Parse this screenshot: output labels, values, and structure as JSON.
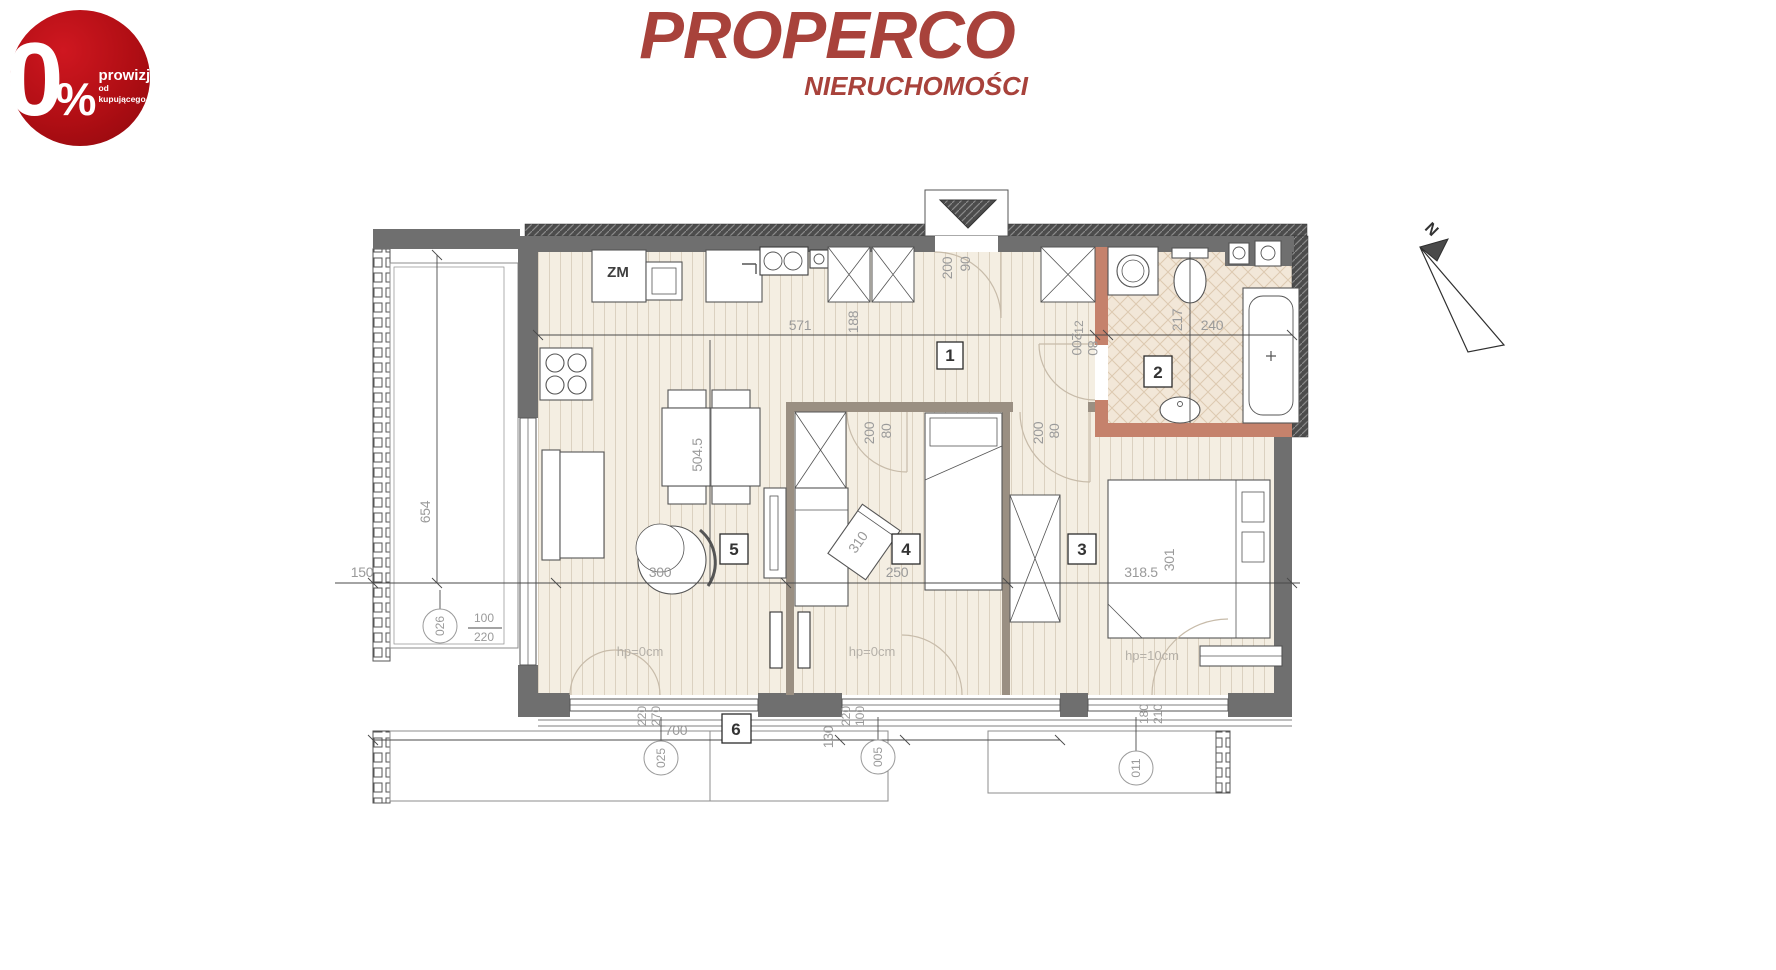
{
  "badge": {
    "zero": "0",
    "percent": "%",
    "line1": "prowizji",
    "line2": "od kupującego",
    "color": "#b00e14"
  },
  "logo": {
    "title": "PROPERCO",
    "subtitle": "NIERUCHOMOŚCI",
    "color": "#a8423b"
  },
  "plan": {
    "compass_n": "N",
    "room_numbers": {
      "hall": "1",
      "bathroom": "2",
      "bedroom_large": "3",
      "bedroom_small": "4",
      "living": "5",
      "terrace": "6"
    },
    "labels": {
      "kitchen_unit": "ZM",
      "parapet_left": "hp=0cm",
      "parapet_mid": "hp=0cm",
      "parapet_right": "hp=10cm"
    },
    "dimensions": {
      "hall_width": "571",
      "hall_depth": "188",
      "entry_wall": "200",
      "entry_door": "90",
      "bath_door_wall": "200",
      "bath_door": "80",
      "bath_jamb": "12",
      "bath_width": "240",
      "bath_depth": "217",
      "living_length": "504.5",
      "living_width": "300",
      "desk": "310",
      "room4_width": "250",
      "room4_door_wall": "200",
      "room4_door": "80",
      "room3_width": "318.5",
      "room3_length": "301",
      "room3_door_wall": "200",
      "room3_door": "80",
      "balcony_length": "654",
      "balcony_width": "150",
      "window_w": "100",
      "window_h": "220",
      "terrace_width": "700",
      "terrace_depth": "130",
      "dw1_a": "220",
      "dw1_b": "270",
      "dw2_a": "220",
      "dw2_b": "100",
      "dw3_a": "180",
      "dw3_b": "210"
    },
    "refs": {
      "window_left": "026",
      "window_terrace": "025",
      "door_terrace": "005",
      "window_right": "011"
    },
    "colors": {
      "wall_gray": "#6f6f6f",
      "bath_wall": "#c5826c",
      "interior_wall": "#9a8f82",
      "wood_floor": "#f4eee2",
      "tile_floor": "#f2e7d8"
    }
  }
}
